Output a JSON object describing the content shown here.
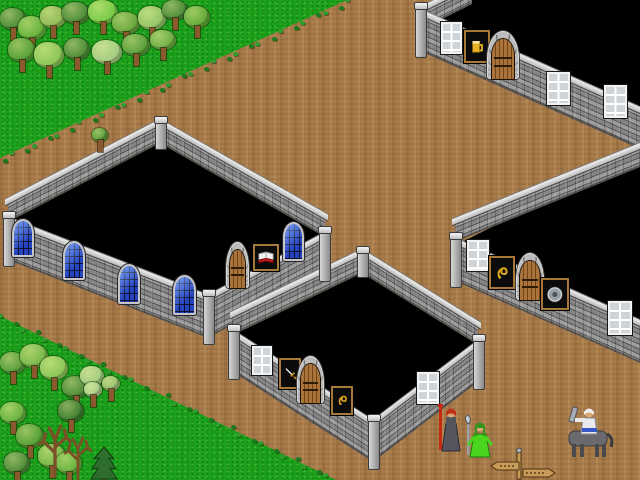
{
  "meta": {
    "description": "Pixel-art tile game scene: roofless stone buildings with black unexplored interiors around a dirt crossroads, forest in two corners, three figures and a signpost",
    "viewport": {
      "width": 640,
      "height": 480
    }
  },
  "colors": {
    "dirt": "#a97c4b",
    "grass": "#1ca11c",
    "interior": "#000000",
    "wall": "#8f8f8f",
    "wall_mortar": "#515151",
    "coping": "#e8e8e8",
    "wood_door": "#a9743c",
    "glass_blue": "#2c50d8",
    "window_white": "#f2f2f2",
    "sign_frame": "#a87838",
    "sign_bg": "#0b0b0b",
    "gold": "#e0a81e",
    "silver": "#d4d8e0"
  },
  "terrain": {
    "grass_regions": [
      {
        "name": "grass-top-left",
        "points": [
          [
            0,
            0
          ],
          [
            347,
            0
          ],
          [
            0,
            158
          ]
        ]
      },
      {
        "name": "grass-bottom-left",
        "points": [
          [
            0,
            316
          ],
          [
            336,
            480
          ],
          [
            0,
            480
          ]
        ]
      }
    ],
    "edges": [
      {
        "x1": 347,
        "y1": 0,
        "x2": 0,
        "y2": 158
      },
      {
        "x1": 0,
        "y1": 316,
        "x2": 336,
        "y2": 480
      }
    ],
    "tuft_colors": [
      "#2f9e2f",
      "#1d7a1d"
    ]
  },
  "buildings": [
    {
      "id": "tavern-building",
      "sign_icon": "mug-icon",
      "interior": [
        [
          422,
          15
        ],
        [
          470,
          0
        ],
        [
          640,
          0
        ],
        [
          640,
          110
        ]
      ],
      "walls": [
        {
          "name": "back-left-wall",
          "x": 420,
          "y": 12,
          "len": 52,
          "drop": -26,
          "h": 18
        },
        {
          "name": "front-wall",
          "x": 420,
          "y": 14,
          "len": 220,
          "drop": 98,
          "h": 37
        }
      ],
      "posts": [
        {
          "x": 415,
          "y": 6,
          "w": 10,
          "h": 50
        }
      ],
      "features": [
        {
          "type": "window",
          "x": 441,
          "y": 22,
          "w": 17,
          "h": 28
        },
        {
          "type": "sign",
          "emblem": "mug",
          "x": 464,
          "y": 30,
          "w": 22,
          "h": 29
        },
        {
          "type": "door",
          "x": 487,
          "y": 31,
          "w": 32,
          "h": 48
        },
        {
          "type": "window",
          "x": 547,
          "y": 72,
          "w": 19,
          "h": 29
        },
        {
          "type": "window",
          "x": 604,
          "y": 85,
          "w": 19,
          "h": 29
        }
      ]
    },
    {
      "id": "library-building",
      "sign_icon": "open-book-icon",
      "interior": [
        [
          160,
          143
        ],
        [
          8,
          222
        ],
        [
          208,
          300
        ],
        [
          325,
          237
        ]
      ],
      "walls": [
        {
          "name": "back-left-wall",
          "x": 8,
          "y": 203,
          "len": 152,
          "drop": -79,
          "h": 19
        },
        {
          "name": "back-right-wall",
          "x": 160,
          "y": 124,
          "len": 165,
          "drop": 94,
          "h": 19
        },
        {
          "name": "front-left-wall",
          "x": 8,
          "y": 222,
          "len": 200,
          "drop": 78,
          "h": 38
        },
        {
          "name": "front-right-wall",
          "x": 208,
          "y": 300,
          "len": 117,
          "drop": -63,
          "h": 38
        }
      ],
      "posts": [
        {
          "x": 3,
          "y": 215,
          "w": 10,
          "h": 50
        },
        {
          "x": 203,
          "y": 293,
          "w": 10,
          "h": 50
        },
        {
          "x": 319,
          "y": 230,
          "w": 10,
          "h": 50
        },
        {
          "x": 155,
          "y": 120,
          "w": 10,
          "h": 28
        }
      ],
      "features": [
        {
          "type": "bluewindow",
          "x": 12,
          "y": 219,
          "w": 18,
          "h": 34
        },
        {
          "type": "bluewindow",
          "x": 63,
          "y": 241,
          "w": 18,
          "h": 35
        },
        {
          "type": "bluewindow",
          "x": 118,
          "y": 264,
          "w": 18,
          "h": 36
        },
        {
          "type": "bluewindow",
          "x": 173,
          "y": 275,
          "w": 19,
          "h": 36
        },
        {
          "type": "door",
          "x": 226,
          "y": 242,
          "w": 23,
          "h": 46
        },
        {
          "type": "sign",
          "emblem": "book",
          "x": 253,
          "y": 244,
          "w": 22,
          "h": 23
        },
        {
          "type": "bluewindow",
          "x": 283,
          "y": 222,
          "w": 17,
          "h": 35
        }
      ]
    },
    {
      "id": "weapon-shop-building",
      "sign_icon": "sword-icon",
      "interior": [
        [
          362,
          273
        ],
        [
          233,
          335
        ],
        [
          373,
          425
        ],
        [
          478,
          345
        ]
      ],
      "walls": [
        {
          "name": "back-left-wall",
          "x": 233,
          "y": 316,
          "len": 129,
          "drop": -62,
          "h": 19
        },
        {
          "name": "back-right-wall",
          "x": 362,
          "y": 254,
          "len": 116,
          "drop": 72,
          "h": 19
        },
        {
          "name": "front-left-wall",
          "x": 233,
          "y": 335,
          "len": 140,
          "drop": 90,
          "h": 37
        },
        {
          "name": "front-right-wall",
          "x": 373,
          "y": 425,
          "len": 105,
          "drop": -80,
          "h": 37
        }
      ],
      "posts": [
        {
          "x": 228,
          "y": 328,
          "w": 10,
          "h": 50
        },
        {
          "x": 368,
          "y": 418,
          "w": 10,
          "h": 50
        },
        {
          "x": 473,
          "y": 338,
          "w": 10,
          "h": 50
        },
        {
          "x": 357,
          "y": 250,
          "w": 10,
          "h": 26
        }
      ],
      "features": [
        {
          "type": "window",
          "x": 252,
          "y": 346,
          "w": 16,
          "h": 25
        },
        {
          "type": "sign",
          "emblem": "sword",
          "x": 279,
          "y": 358,
          "w": 18,
          "h": 27
        },
        {
          "type": "door",
          "x": 297,
          "y": 356,
          "w": 27,
          "h": 47
        },
        {
          "type": "sign",
          "emblem": "crest",
          "x": 331,
          "y": 386,
          "w": 18,
          "h": 25
        },
        {
          "type": "window",
          "x": 417,
          "y": 372,
          "w": 18,
          "h": 28
        }
      ]
    },
    {
      "id": "armoury-building",
      "sign_icon": "shield-icon",
      "interior": [
        [
          458,
          244
        ],
        [
          640,
          153
        ],
        [
          640,
          324
        ]
      ],
      "walls": [
        {
          "name": "back-left-wall",
          "x": 455,
          "y": 223,
          "len": 185,
          "drop": -75,
          "h": 19
        },
        {
          "name": "front-wall",
          "x": 455,
          "y": 243,
          "len": 185,
          "drop": 82,
          "h": 38
        }
      ],
      "posts": [
        {
          "x": 450,
          "y": 236,
          "w": 10,
          "h": 50
        }
      ],
      "features": [
        {
          "type": "window",
          "x": 467,
          "y": 240,
          "w": 18,
          "h": 27
        },
        {
          "type": "sign",
          "emblem": "crest",
          "x": 489,
          "y": 256,
          "w": 22,
          "h": 29
        },
        {
          "type": "door",
          "x": 516,
          "y": 253,
          "w": 28,
          "h": 47
        },
        {
          "type": "sign",
          "emblem": "shield",
          "x": 541,
          "y": 278,
          "w": 24,
          "h": 28
        },
        {
          "type": "window",
          "x": 608,
          "y": 301,
          "w": 20,
          "h": 30
        }
      ]
    }
  ],
  "trees": [
    {
      "type": "deciduous",
      "x": 0,
      "y": 8,
      "w": 26,
      "h": 22,
      "c": "#4d8c38"
    },
    {
      "type": "deciduous",
      "x": 18,
      "y": 16,
      "w": 28,
      "h": 24,
      "c": "#68b23e"
    },
    {
      "type": "deciduous",
      "x": 40,
      "y": 6,
      "w": 26,
      "h": 22,
      "c": "#8fba55"
    },
    {
      "type": "deciduous",
      "x": 62,
      "y": 2,
      "w": 28,
      "h": 22,
      "c": "#4d8c38"
    },
    {
      "type": "deciduous",
      "x": 88,
      "y": 0,
      "w": 30,
      "h": 24,
      "c": "#79c947"
    },
    {
      "type": "deciduous",
      "x": 112,
      "y": 12,
      "w": 28,
      "h": 22,
      "c": "#68a83c"
    },
    {
      "type": "deciduous",
      "x": 138,
      "y": 6,
      "w": 28,
      "h": 24,
      "c": "#93c566"
    },
    {
      "type": "deciduous",
      "x": 162,
      "y": 0,
      "w": 26,
      "h": 20,
      "c": "#4d8c38"
    },
    {
      "type": "deciduous",
      "x": 184,
      "y": 6,
      "w": 26,
      "h": 22,
      "c": "#63aa3a"
    },
    {
      "type": "deciduous",
      "x": 8,
      "y": 38,
      "w": 28,
      "h": 24,
      "c": "#57a035"
    },
    {
      "type": "deciduous",
      "x": 34,
      "y": 42,
      "w": 30,
      "h": 26,
      "c": "#8cc658"
    },
    {
      "type": "deciduous",
      "x": 64,
      "y": 38,
      "w": 26,
      "h": 22,
      "c": "#4d8c38"
    },
    {
      "type": "deciduous",
      "x": 92,
      "y": 40,
      "w": 30,
      "h": 24,
      "c": "#a3cc80"
    },
    {
      "type": "deciduous",
      "x": 122,
      "y": 34,
      "w": 28,
      "h": 22,
      "c": "#5a9e3a"
    },
    {
      "type": "deciduous",
      "x": 150,
      "y": 30,
      "w": 26,
      "h": 20,
      "c": "#6fae44"
    },
    {
      "type": "deciduous",
      "x": 92,
      "y": 128,
      "w": 16,
      "h": 14,
      "c": "#5a9e3a"
    },
    {
      "type": "deciduous",
      "x": 0,
      "y": 352,
      "w": 26,
      "h": 22,
      "c": "#5a9e3a"
    },
    {
      "type": "deciduous",
      "x": 20,
      "y": 344,
      "w": 28,
      "h": 24,
      "c": "#79b84a"
    },
    {
      "type": "deciduous",
      "x": 40,
      "y": 356,
      "w": 28,
      "h": 24,
      "c": "#8cc658"
    },
    {
      "type": "deciduous",
      "x": 62,
      "y": 376,
      "w": 28,
      "h": 22,
      "c": "#4d8c38"
    },
    {
      "type": "deciduous",
      "x": 80,
      "y": 366,
      "w": 24,
      "h": 20,
      "c": "#a3cc80"
    },
    {
      "type": "deciduous",
      "x": 0,
      "y": 402,
      "w": 26,
      "h": 22,
      "c": "#68b23e"
    },
    {
      "type": "deciduous",
      "x": 16,
      "y": 424,
      "w": 28,
      "h": 24,
      "c": "#57a035"
    },
    {
      "type": "deciduous",
      "x": 38,
      "y": 444,
      "w": 28,
      "h": 24,
      "c": "#79b84a"
    },
    {
      "type": "deciduous",
      "x": 4,
      "y": 452,
      "w": 26,
      "h": 22,
      "c": "#4d8c38"
    },
    {
      "type": "deciduous",
      "x": 56,
      "y": 452,
      "w": 26,
      "h": 22,
      "c": "#68b23e"
    },
    {
      "type": "deciduous",
      "x": 84,
      "y": 382,
      "w": 18,
      "h": 15,
      "c": "#aacf8c"
    },
    {
      "type": "deciduous",
      "x": 102,
      "y": 376,
      "w": 18,
      "h": 15,
      "c": "#98c070"
    },
    {
      "type": "deciduous",
      "x": 58,
      "y": 400,
      "w": 26,
      "h": 22,
      "c": "#3f7f2f"
    },
    {
      "type": "dead",
      "x": 36,
      "y": 412,
      "w": 38,
      "h": 62
    },
    {
      "type": "dead",
      "x": 62,
      "y": 424,
      "w": 32,
      "h": 54
    },
    {
      "type": "pine",
      "x": 90,
      "y": 438,
      "w": 28,
      "h": 42
    }
  ],
  "characters": [
    {
      "id": "priest-with-red-staff",
      "type": "robed",
      "x": 436,
      "y": 402,
      "w": 30,
      "h": 52,
      "colors": {
        "robe": "#55555e",
        "robe_dark": "#2c2c33",
        "hair": "#c03018",
        "skin": "#d8a878",
        "staff": "#c62a12"
      }
    },
    {
      "id": "green-robed-woman",
      "type": "robed2",
      "x": 463,
      "y": 415,
      "w": 32,
      "h": 44,
      "colors": {
        "robe": "#49d41e",
        "robe_dark": "#1f7a10",
        "hair": "#2f9418",
        "skin": "#d8a878",
        "scythe": "#9aa0a8",
        "blade": "#c6ccd6"
      }
    },
    {
      "id": "centaur",
      "type": "centaur",
      "x": 559,
      "y": 404,
      "w": 58,
      "h": 56,
      "colors": {
        "body": "#6a6a6e",
        "legs": "#4a4a4e",
        "shirt": "#e9e9ee",
        "trim": "#3858c8",
        "hair": "#f0f0f2",
        "skin": "#d8a878",
        "club": "#a8acb4"
      }
    }
  ],
  "signpost": {
    "id": "direction-signpost",
    "x": 489,
    "y": 447,
    "w": 70,
    "h": 34,
    "wood": "#c89c58",
    "outline": "#4a3210"
  }
}
